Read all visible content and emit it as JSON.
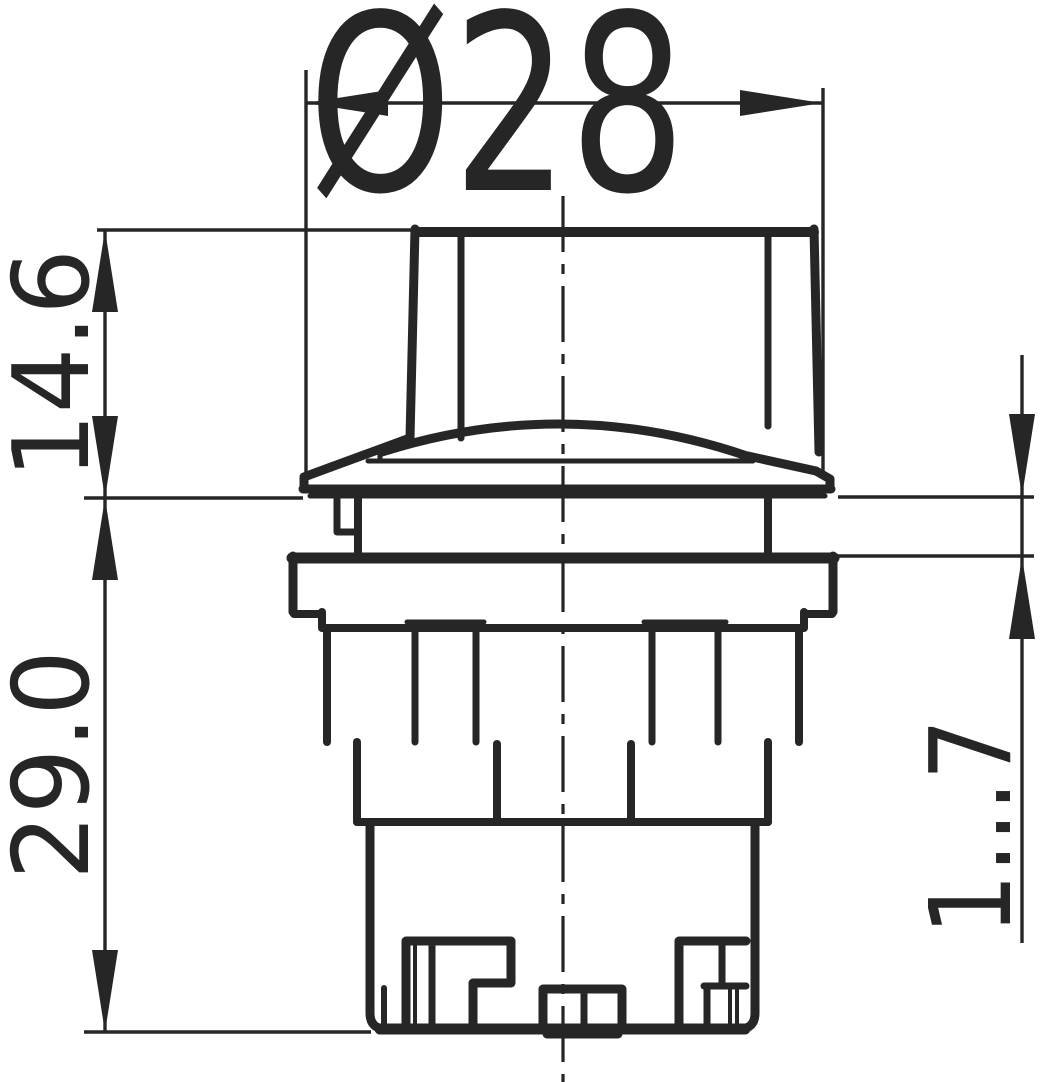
{
  "drawing": {
    "background_color": "#ffffff",
    "line_color": "#262626",
    "dimensions": {
      "diameter": {
        "label": "Ø28"
      },
      "upper_height": {
        "label": "14.6"
      },
      "lower_height": {
        "label": "29.0"
      },
      "panel_thickness_range": {
        "label": "1...7"
      }
    }
  }
}
